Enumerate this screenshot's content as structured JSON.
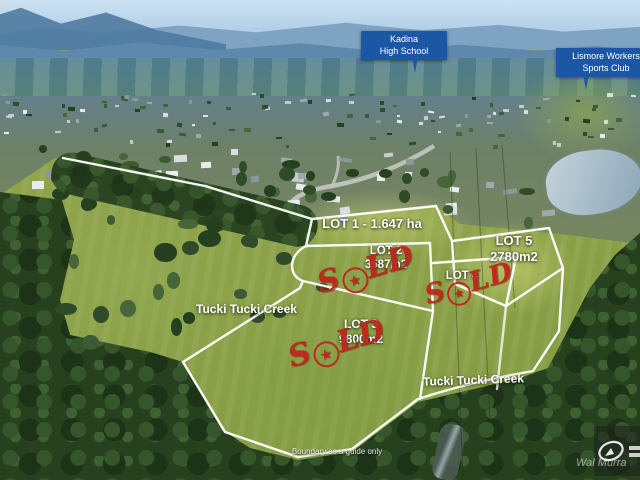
{
  "overlays": {
    "badges": [
      {
        "id": "kadina-high-school",
        "lines": [
          "Kadina",
          "High School"
        ]
      },
      {
        "id": "lismore-workers-sports-club",
        "lines": [
          "Lismore Workers",
          "Sports Club"
        ]
      }
    ],
    "lots": {
      "lot1": {
        "label": "LOT 1 - 1.647 ha"
      },
      "lot2": {
        "name": "LOT 2",
        "area": "3587m2",
        "status": "SOLD"
      },
      "lot3": {
        "name": "LOT 3",
        "area": "9800m2",
        "status": "SOLD"
      },
      "lot4": {
        "name": "LOT 4",
        "status": "SOLD"
      },
      "lot5": {
        "name": "LOT 5",
        "area": "2780m2"
      }
    },
    "creek": {
      "label": "Tucki Tucki Creek"
    },
    "disclaimer": "Boundary as a guide only",
    "sold": {
      "s": "S",
      "star": "★",
      "ld": "LD",
      "full": "SOLD"
    },
    "watermark": "Wal Murra"
  },
  "colors": {
    "badge_blue": "#1b57a5",
    "sold_red": "#c2231b",
    "boundary_white": "#ffffff",
    "paddock_green": "#8aa047",
    "forest_green": "#27411f",
    "sky_blue": "#cde2f2"
  }
}
